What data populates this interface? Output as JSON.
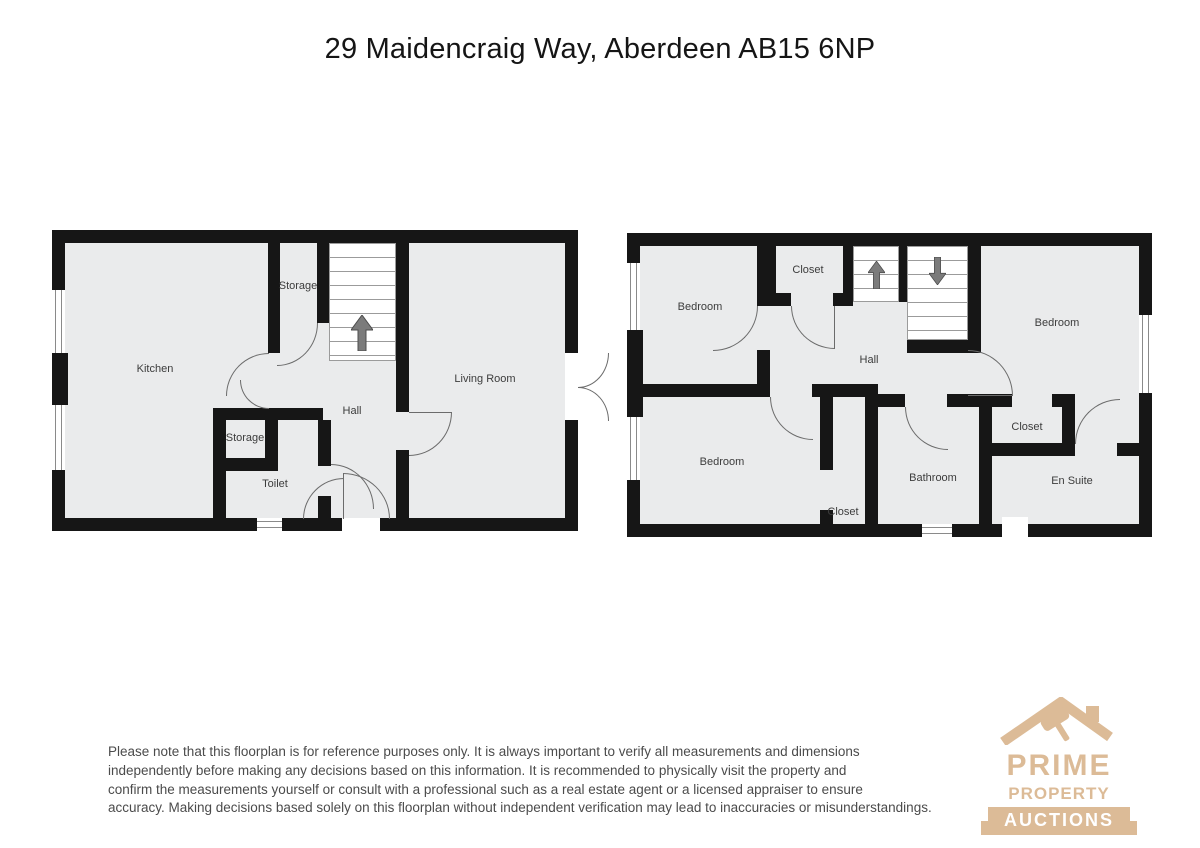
{
  "title": "29 Maidencraig Way, Aberdeen AB15 6NP",
  "ground_floor": {
    "rooms": [
      {
        "label": "Kitchen"
      },
      {
        "label": "Storage"
      },
      {
        "label": "Hall"
      },
      {
        "label": "Storage"
      },
      {
        "label": "Toilet"
      },
      {
        "label": "Living Room"
      }
    ]
  },
  "first_floor": {
    "rooms": [
      {
        "label": "Bedroom"
      },
      {
        "label": "Closet"
      },
      {
        "label": "Hall"
      },
      {
        "label": "Bedroom"
      },
      {
        "label": "Bedroom"
      },
      {
        "label": "Closet"
      },
      {
        "label": "Bathroom"
      },
      {
        "label": "Closet"
      },
      {
        "label": "En Suite"
      }
    ]
  },
  "disclaimer": {
    "lines": [
      "Please note that this floorplan is for reference purposes only. It is always important to verify all measurements and dimensions",
      "independently before making any decisions based on this information. It is recommended to physically visit the property and",
      "confirm the measurements yourself or consult with a professional such as a real estate agent or a licensed appraiser to ensure",
      "accuracy. Making decisions based solely on this floorplan without independent verification may lead to inaccuracies or misunderstandings."
    ]
  },
  "logo": {
    "line1": "PRIME",
    "line2": "PROPERTY",
    "line3": "AUCTIONS"
  },
  "icons": {
    "stairs_up_arrow": "up-arrow",
    "stairs_down_arrow": "down-arrow",
    "logo_roof": "house-roof-with-chimney",
    "logo_gavel": "auction-gavel"
  },
  "colors": {
    "wall": "#161616",
    "room_fill": "#eaebec",
    "label_text": "#3c3c3c",
    "stair_arrow": "#7b7b7b",
    "logo_tan": "#dcbb97",
    "disclaimer_text": "#4b4b4b"
  }
}
